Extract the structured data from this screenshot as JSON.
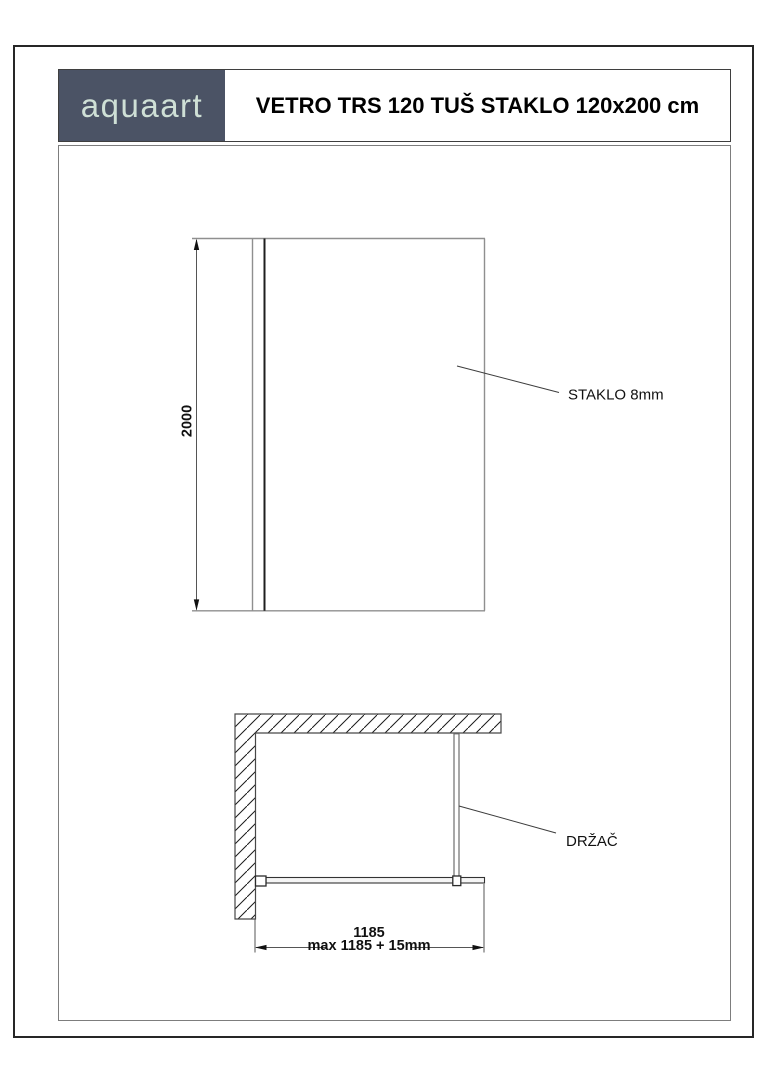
{
  "header": {
    "logo_text": "aquaart",
    "title": "VETRO TRS 120 TUŠ STAKLO 120x200 cm"
  },
  "front_view": {
    "height_dimension": "2000",
    "glass_label": "STAKLO 8mm"
  },
  "plan_view": {
    "support_label": "DRŽAČ",
    "width_dimension": "1185",
    "width_dimension_max": "max 1185 + 15mm"
  },
  "colors": {
    "logo_background": "#4b5365",
    "logo_text": "#cfe0d6",
    "drawing_outline_gray": "#8f8f8f",
    "drawing_line_dark": "#1f1f1f",
    "page_border": "#262626"
  }
}
